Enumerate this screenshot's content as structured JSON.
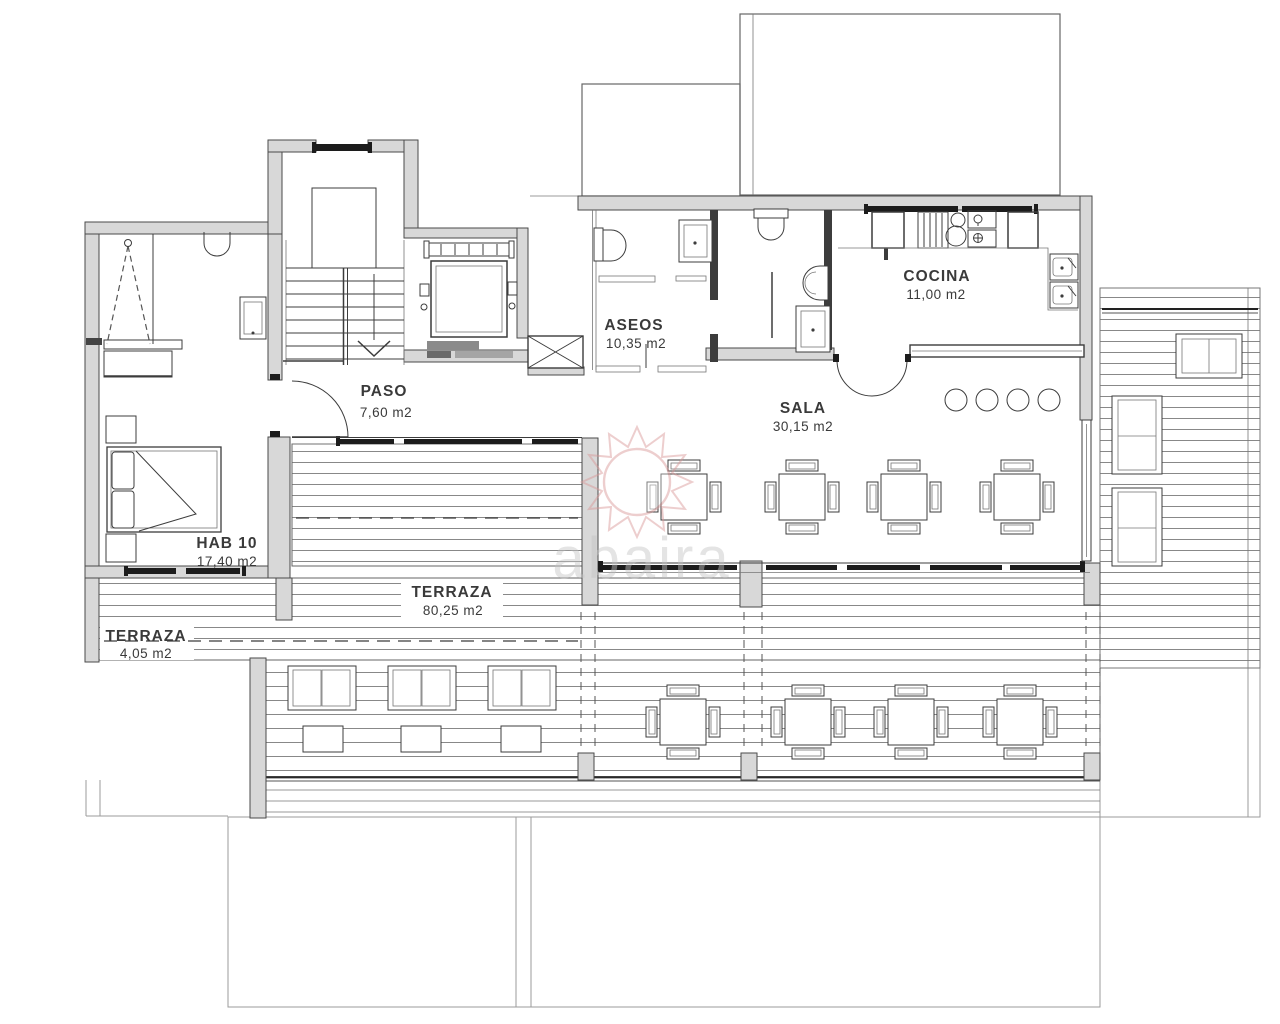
{
  "rooms": {
    "paso": {
      "name": "PASO",
      "area": "7,60 m2"
    },
    "hab10": {
      "name": "HAB 10",
      "area": "17,40 m2"
    },
    "aseos": {
      "name": "ASEOS",
      "area": "10,35 m2"
    },
    "cocina": {
      "name": "COCINA",
      "area": "11,00 m2"
    },
    "sala": {
      "name": "SALA",
      "area": "30,15 m2"
    },
    "terraza_main": {
      "name": "TERRAZA",
      "area": "80,25 m2"
    },
    "terraza_small": {
      "name": "TERRAZA",
      "area": "4,05 m2"
    }
  },
  "watermark": {
    "text": "abaira"
  },
  "colors": {
    "wall_fill": "#d8d8d8",
    "wall_stroke": "#4a4a4a",
    "line": "#3c3c3c",
    "deck_line": "#7a7a7a",
    "ghost_line": "#9b9b9b",
    "glazing": "#1c1c1c",
    "watermark_sun": "#d89595",
    "watermark_text": "#c4c4c4",
    "label_text": "#3a3a3a"
  }
}
